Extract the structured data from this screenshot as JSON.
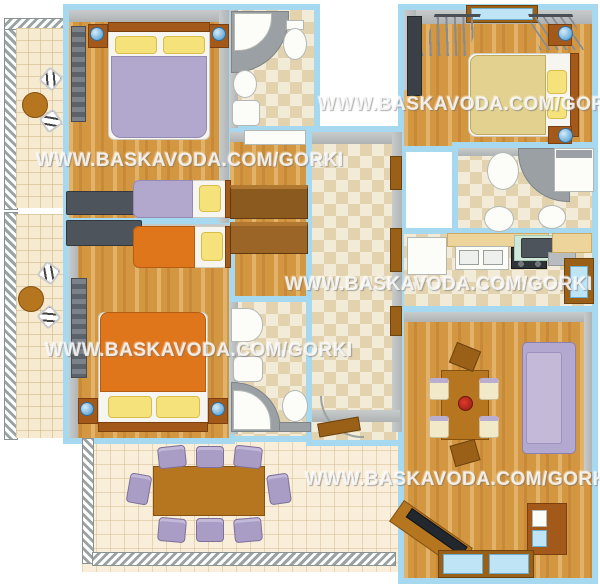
{
  "watermarks": [
    {
      "text": "WWW.BASKAVODA.COM/GORKI"
    },
    {
      "text": "WWW.BASKAVODA.COM/GORKI"
    },
    {
      "text": "WWW.BASKAVODA.COM/GORKI"
    },
    {
      "text": "WWW.BASKAVODA.COM/GORKI"
    },
    {
      "text": "WWW.BASKAVODA.COM/GORKI"
    }
  ],
  "colors": {
    "wall_blue": "#a6d8f0",
    "interior_wall_gray": "#b0b4b4",
    "wood_floor": "#d39742",
    "tile_floor": "#f2ebd8",
    "tile_diamond": "#e2d3ae",
    "balcony_floor": "#f6ead0",
    "blanket_purple": "#b2a7cd",
    "blanket_orange": "#e0761c",
    "blanket_tan": "#e2d18f",
    "pillow_yellow": "#f6e27a",
    "sofa_purple": "#b3a8cf",
    "furniture_wood": "#b5761f",
    "headboard_brown": "#a3591a",
    "appliance_dark": "#4e545c",
    "lamp_blue": "#3f92cc",
    "fixture_white": "#fcfcf8",
    "shower_gray": "#9aa0a3",
    "glass_blue": "#bfe4f5",
    "watermark_white": "#ffffff"
  }
}
